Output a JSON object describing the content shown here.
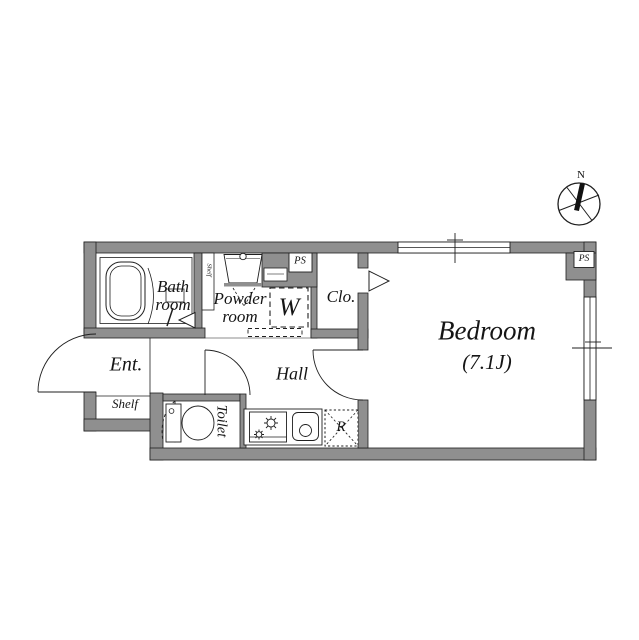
{
  "floorplan": {
    "rooms": {
      "bathroom": "Bath\nroom",
      "powder_room": "Powder\nroom",
      "closet": "Clo.",
      "bedroom": "Bedroom",
      "bedroom_size": "(7.1J)",
      "entrance": "Ent.",
      "hall": "Hall",
      "toilet": "Toilet",
      "shelf": "Shelf",
      "shelf_niche": "Shelf"
    },
    "fixtures": {
      "washing_machine": "W",
      "refrigerator": "R",
      "pipe_space_top": "PS",
      "pipe_space_corner": "PS"
    },
    "compass": {
      "north": "N"
    },
    "colors": {
      "wall": "#8f8f8f",
      "line": "#1f1f1f",
      "background": "#ffffff"
    }
  }
}
